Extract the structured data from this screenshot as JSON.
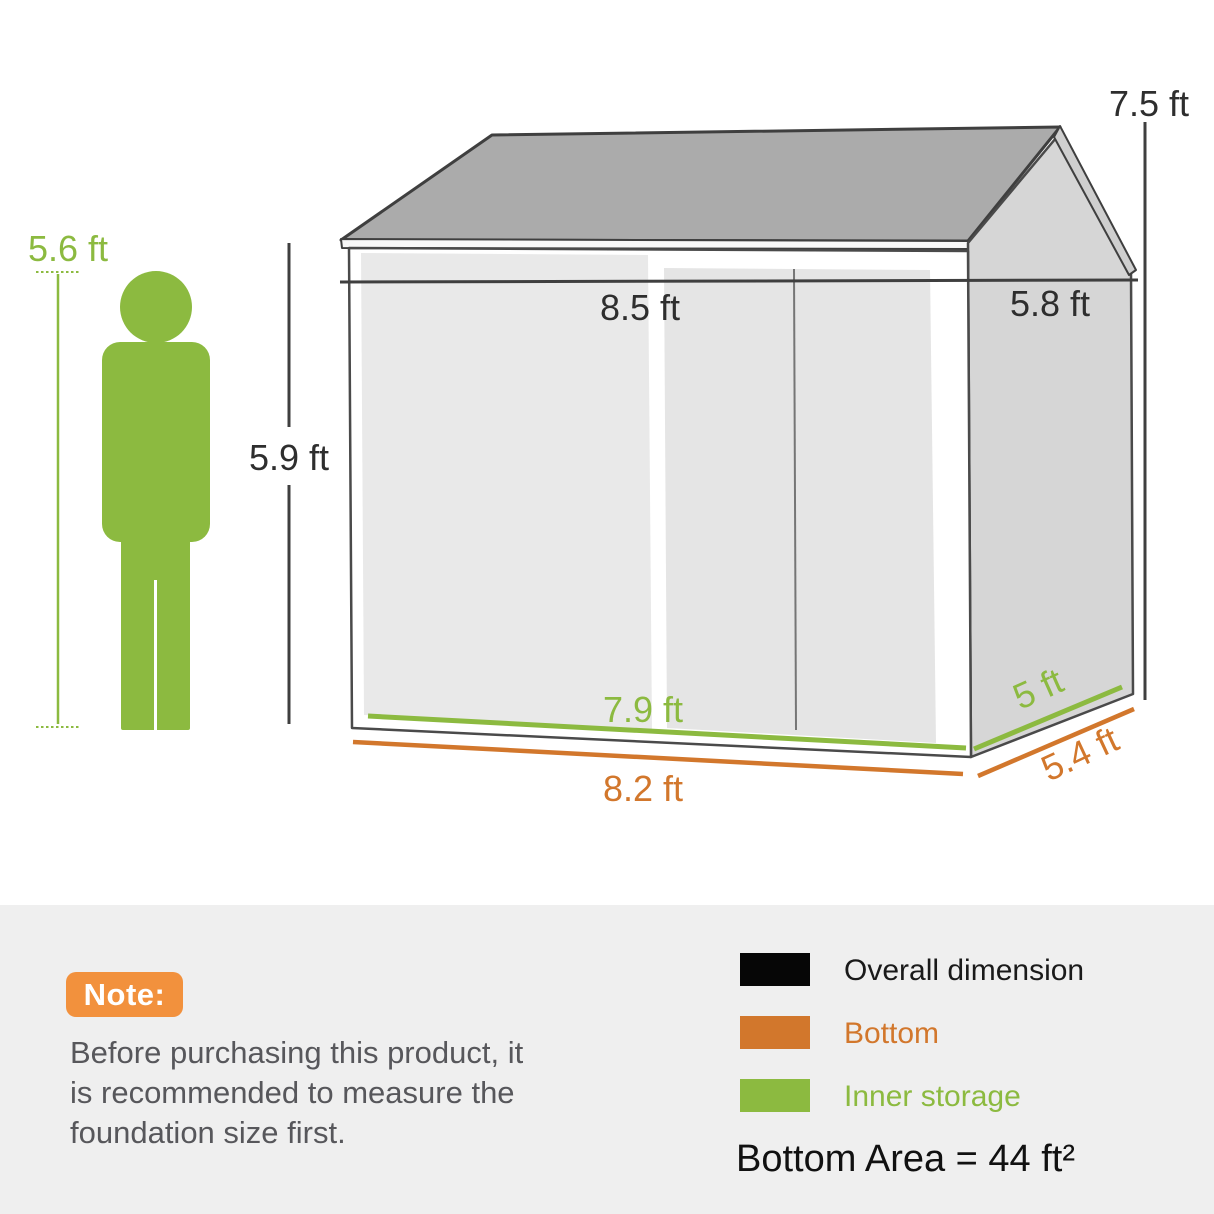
{
  "dimensions": {
    "person_height": "5.6 ft",
    "wall_height": "5.9 ft",
    "overall_width": "8.5 ft",
    "overall_depth": "5.8 ft",
    "overall_height": "7.5 ft",
    "inner_width": "7.9 ft",
    "inner_depth": "5 ft",
    "bottom_width": "8.2 ft",
    "bottom_depth": "5.4 ft"
  },
  "note": {
    "badge_label": "Note:",
    "lines": [
      "Before purchasing this product, it",
      "is recommended to measure the",
      "foundation size first."
    ]
  },
  "legend": {
    "items": [
      {
        "label": "Overall dimension",
        "color": "#060606"
      },
      {
        "label": "Bottom",
        "color": "#D2772C"
      },
      {
        "label": "Inner storage",
        "color": "#8CBA40"
      }
    ],
    "bottom_area": "Bottom Area = 44 ft²"
  },
  "colors": {
    "inner_storage_green": "#8CBA40",
    "bottom_orange": "#D2772C",
    "note_badge_orange": "#F2913D",
    "overall_dimension_line": "#3F3F3F",
    "panel_background": "#EFEFEF",
    "roof_gray": "#ABABAB",
    "side_wall_gray": "#D6D6D6",
    "front_wall_gray": "#E9E9E9"
  }
}
